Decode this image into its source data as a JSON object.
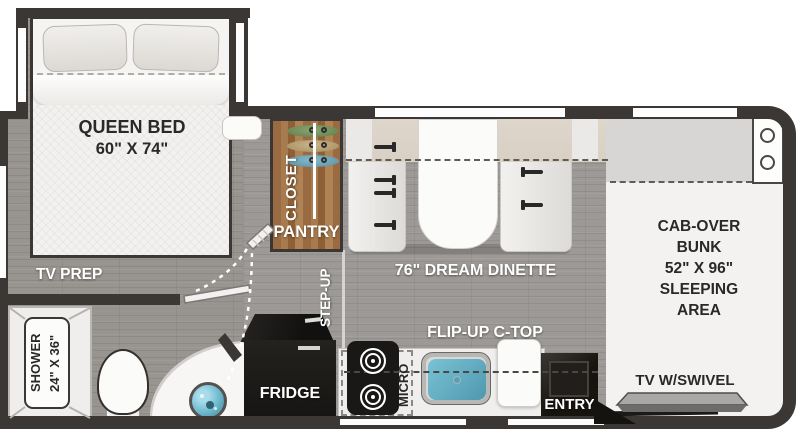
{
  "floorplan": {
    "type": "rv-floorplan",
    "labels": {
      "queen_bed_1": "QUEEN BED",
      "queen_bed_2": "60\" X 74\"",
      "closet": "CLOSET",
      "pantry": "PANTRY",
      "tv_prep": "TV PREP",
      "step_up": "STEP-UP",
      "dinette": "76\" DREAM DINETTE",
      "bunk_1": "CAB-OVER",
      "bunk_2": "BUNK",
      "bunk_3": "52\" X 96\"",
      "bunk_4": "SLEEPING",
      "bunk_5": "AREA",
      "shower_1": "SHOWER",
      "shower_2": "24\" X 36\"",
      "fridge": "FRIDGE",
      "micro": "MICRO",
      "flip_up": "FLIP-UP C-TOP",
      "entry": "ENTRY",
      "tv_swivel": "TV W/SWIVEL"
    },
    "colors": {
      "wall": "#3a3734",
      "floor": "#9c9996",
      "bedfloor": "#98948f",
      "closet_wood": "#a0714a",
      "bench": "#e9e8e6",
      "backrest": "#d9d0c4",
      "bunk": "#f3f2f0",
      "bunk_top": "#d7d6d4",
      "appliance": "#1a1816",
      "sink_blue": "#6db9cd",
      "tv_gray": "#a9a8a7",
      "text_dark": "#2b2927",
      "text_white": "#ffffff",
      "hanger_green": "#8ba56f",
      "hanger_tan": "#cbb68c",
      "hanger_blue": "#85b9cb"
    }
  }
}
